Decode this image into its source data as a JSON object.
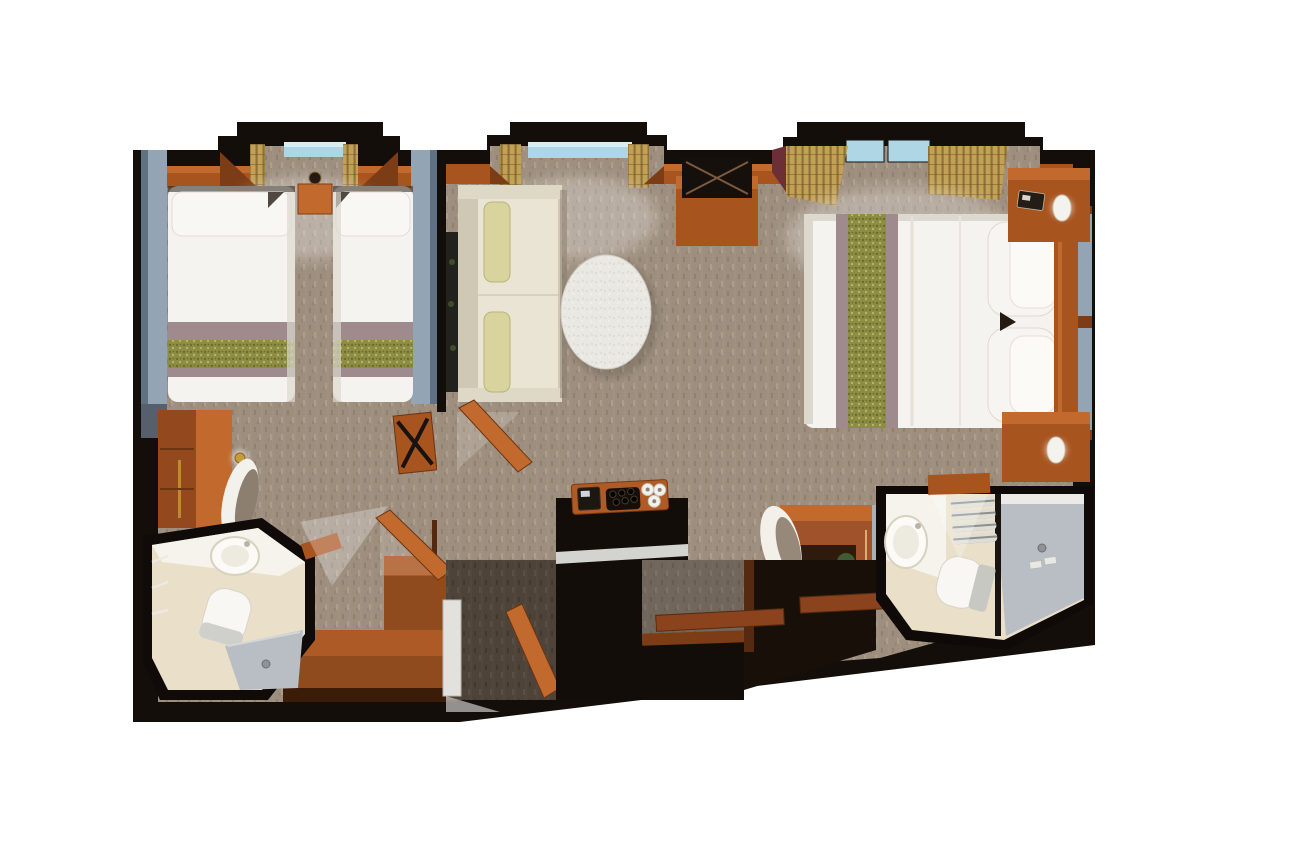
{
  "figure": {
    "type": "floor-plan",
    "view": "top-down 3D render",
    "subject": "Two-bedroom suite stateroom floor plan: twin bedroom with bathroom, living area, master bedroom with bathroom and entry halls",
    "background": "#ffffff"
  },
  "colors": {
    "wall": "#140e0b",
    "wallSoft": "#1c130c",
    "carpet": "#9d8e7e",
    "carpetDark": "#4e4339",
    "carpetSpeckDark": "#84745f",
    "carpetSpeckLight": "#b7a894",
    "wood": "#a8541f",
    "woodLight": "#c26a2e",
    "woodDark": "#7c3d16",
    "woodDeep": "#552a10",
    "bedWhite": "#f4f3ef",
    "bedShadow": "#d9d6cd",
    "mauve": "#9f8b8e",
    "olive": "#8d8d45",
    "oliveDark": "#6c6c2d",
    "oliveLight": "#b7b766",
    "blueGray": "#93a4b4",
    "blueGrayDark": "#5f7183",
    "glassBlue": "#aed6e4",
    "curtainGold": "#c2a156",
    "curtainGoldDark": "#8e7138",
    "maroon": "#6b2f35",
    "sofaCream": "#e9e4d3",
    "sofaEdge": "#cfc8b5",
    "pillowYellow": "#d9d49e",
    "marble": "#e9e8e3",
    "bathFloor": "#eadfc8",
    "fixtureWhite": "#f8f7f3",
    "showerGray": "#b9bec4",
    "mirrorGray": "#a9b1b6",
    "plantGreen": "#3f5c33",
    "plantDark": "#2c4424",
    "gold": "#c79a3a",
    "lampWhite": "#f4f2ec",
    "tvBlack": "#15100c"
  },
  "rooms": [
    {
      "id": "twin-bedroom",
      "label": "Twin bedroom",
      "furniture": [
        "window-bay",
        "twin-bed-left",
        "twin-bed-right",
        "bed-side-panels",
        "twin-nightstand",
        "wall-sconce",
        "dresser",
        "table-lamp",
        "desk-chair",
        "luggage-rack",
        "storage-bench",
        "connecting-doors"
      ]
    },
    {
      "id": "twin-bathroom",
      "label": "Twin bathroom",
      "furniture": [
        "washbasin",
        "toilet",
        "shower",
        "towel-rail",
        "bathroom-door"
      ]
    },
    {
      "id": "living-area",
      "label": "Living area",
      "furniture": [
        "window-bay",
        "sofa",
        "throw-pillows",
        "coffee-table",
        "tv",
        "tv-cabinet",
        "minibar-counter",
        "espresso-tray",
        "mirror-panel"
      ]
    },
    {
      "id": "master-bedroom",
      "label": "Master bedroom",
      "furniture": [
        "window-bay",
        "double-bed",
        "bed-runner",
        "bed-pillows",
        "headboard",
        "glass-panels",
        "nightstand-top",
        "nightstand-bottom",
        "bedside-lamps",
        "phone",
        "vanity-desk",
        "vanity-chair",
        "plant",
        "vanity-mirror"
      ]
    },
    {
      "id": "master-bathroom",
      "label": "Master bathroom",
      "furniture": [
        "washbasin",
        "toilet",
        "towel-shelf",
        "shower",
        "bathroom-door"
      ]
    },
    {
      "id": "entry-hall",
      "label": "Entry halls",
      "furniture": [
        "entry-door",
        "hall-doors",
        "closet-trims",
        "hall-carpet"
      ]
    }
  ]
}
